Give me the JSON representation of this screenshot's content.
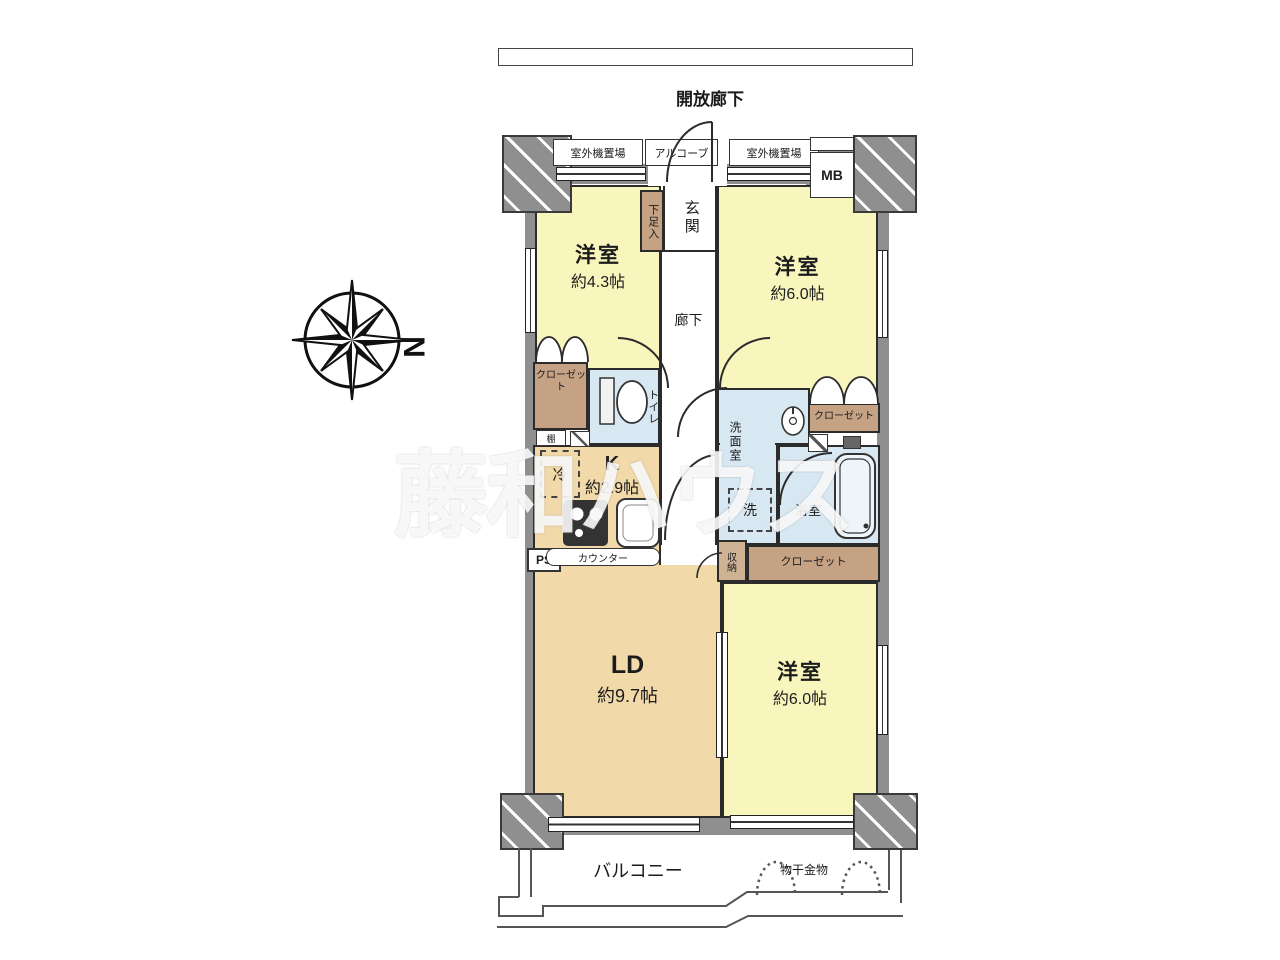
{
  "header": {
    "open_corridor": "開放廊下"
  },
  "exterior": {
    "outdoor_unit_left": "室外機置場",
    "alcove": "アルコーブ",
    "outdoor_unit_right": "室外機置場",
    "meter_box": "MB",
    "balcony": "バルコニー",
    "laundry_hardware": "物干金物"
  },
  "rooms": {
    "western_room_a": {
      "name": "洋室",
      "size": "約4.3帖"
    },
    "western_room_b": {
      "name": "洋室",
      "size": "約6.0帖"
    },
    "western_room_c": {
      "name": "洋室",
      "size": "約6.0帖"
    },
    "living_dining": {
      "name": "LD",
      "size": "約9.7帖"
    },
    "kitchen": {
      "name": "K",
      "size": "約2.9帖"
    },
    "entrance": "玄関",
    "shoe_cabinet": "下足入",
    "hallway": "廊下",
    "toilet": "トイレ",
    "washroom": "洗面室",
    "bathroom": "浴室",
    "storage": "収納",
    "closet_a": "クローゼット",
    "closet_b": "クローゼット",
    "closet_c": "クローゼット",
    "shelf": "棚",
    "refrigerator": "冷",
    "washer": "洗",
    "counter": "カウンター",
    "pipe_space": "PS"
  },
  "compass": {
    "north": "N"
  },
  "watermark": "藤和ハウス",
  "colors": {
    "room_yellow": "#f8f5bd",
    "room_tan": "#f2d9a9",
    "wet_blue": "#d8e8f2",
    "closet_brown": "#c5a284",
    "wall_gray": "#8f8f8f"
  }
}
